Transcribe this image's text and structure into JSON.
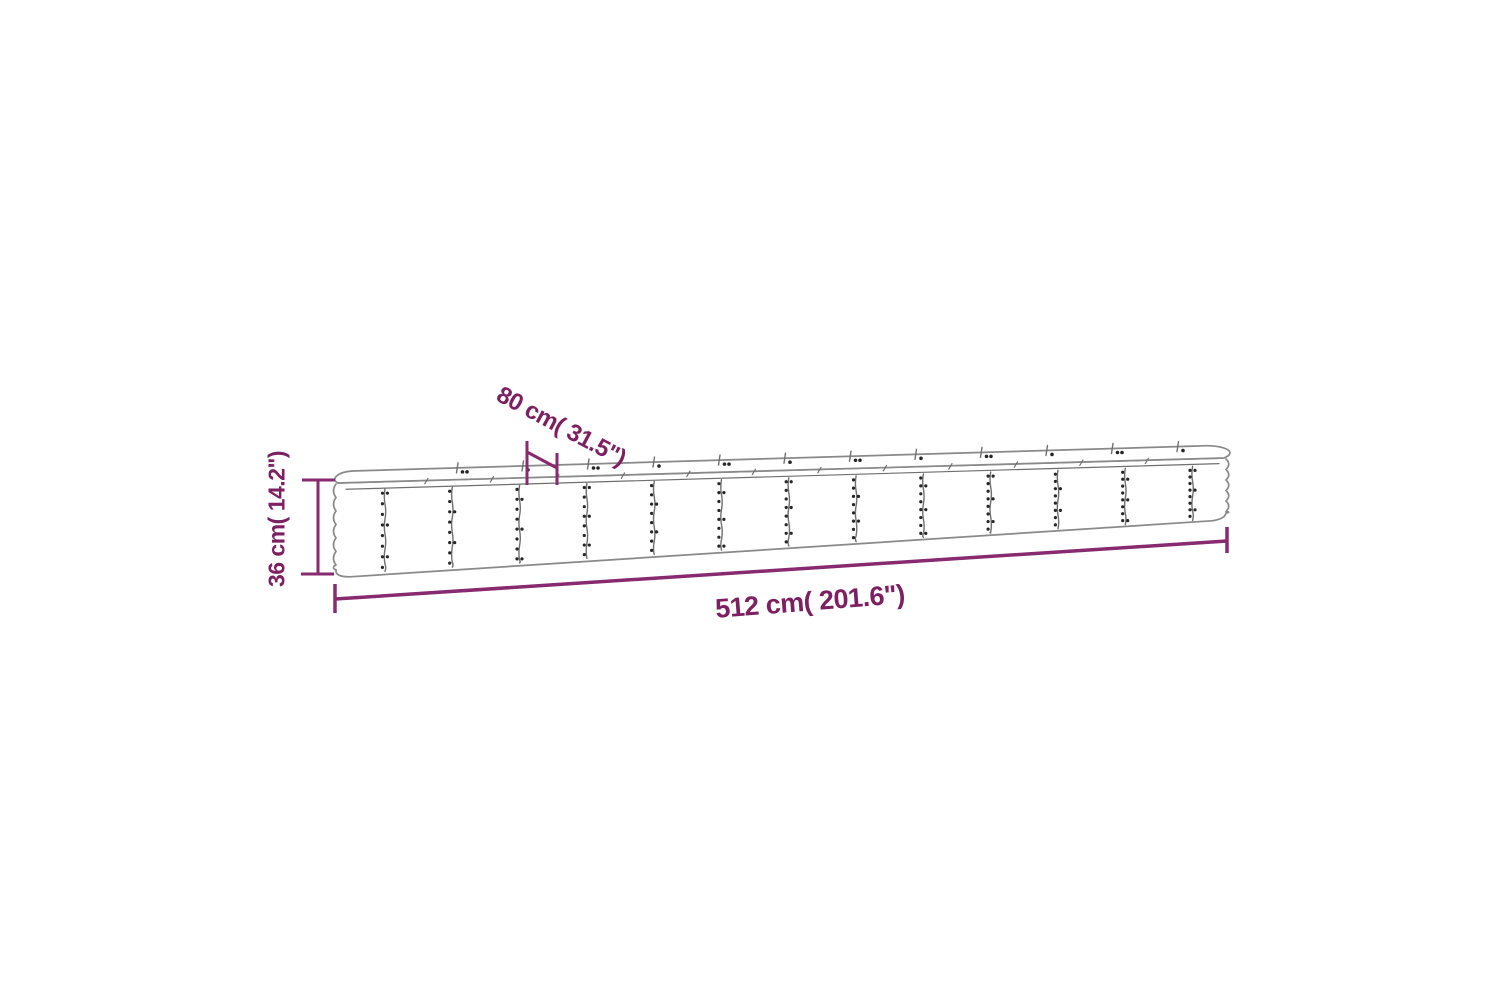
{
  "diagram": {
    "name": "raised-garden-bed-dimension-diagram",
    "labels": {
      "width_label": "80 cm( 31.5\")",
      "height_label": "36 cm( 14.2\")",
      "length_label": "512 cm( 201.6\")"
    },
    "values": {
      "width_cm": 80,
      "width_inch": 31.5,
      "height_cm": 36,
      "height_inch": 14.2,
      "length_cm": 512,
      "length_inch": 201.6
    },
    "colors": {
      "background": "#ffffff",
      "dimension_line": "#882a6f",
      "dimension_text": "#7d2062",
      "outline": "#898989",
      "seam": "#6f6f6f",
      "rivet": "#262626"
    },
    "geometry": {
      "front_top": {
        "x1": 338,
        "y1": 483,
        "x2": 1224,
        "y2": 458
      },
      "back_top": {
        "x1": 352,
        "y1": 471,
        "x2": 1198,
        "y2": 446
      },
      "bottom": {
        "x1": 336,
        "y1": 576,
        "x2": 1222,
        "y2": 520
      },
      "left_x": 336,
      "right_x": 1226,
      "hem_offset": 6,
      "wave": {
        "amplitude": 5,
        "period": 13.5
      },
      "right_wave": {
        "amplitude": 5.5,
        "period": 10.5
      },
      "seams": {
        "start_x": 385,
        "spacing": 67.3,
        "count": 13,
        "rivets": 8
      },
      "back_ticks": {
        "start_x": 458,
        "spacing": 65.5,
        "count": 12
      },
      "front_ticks": {
        "start_x": 428,
        "spacing": 65.5,
        "count": 12
      }
    },
    "dimensions": {
      "height": {
        "line_x": 318,
        "top_y": 480,
        "bottom_y": 574,
        "cap_half": 16,
        "stroke": 3
      },
      "length": {
        "x1": 335,
        "y1": 599,
        "x2": 1227,
        "y2": 541,
        "cap_half": 14,
        "stroke": 3.5
      },
      "width": {
        "near_tick": {
          "x": 527,
          "y1": 441,
          "y2": 485
        },
        "far_tick": {
          "x": 557,
          "y1": 453,
          "y2": 485
        },
        "connector": {
          "x1": 527,
          "y1": 452,
          "x2": 557,
          "y2": 468
        },
        "stroke": 3
      }
    }
  }
}
